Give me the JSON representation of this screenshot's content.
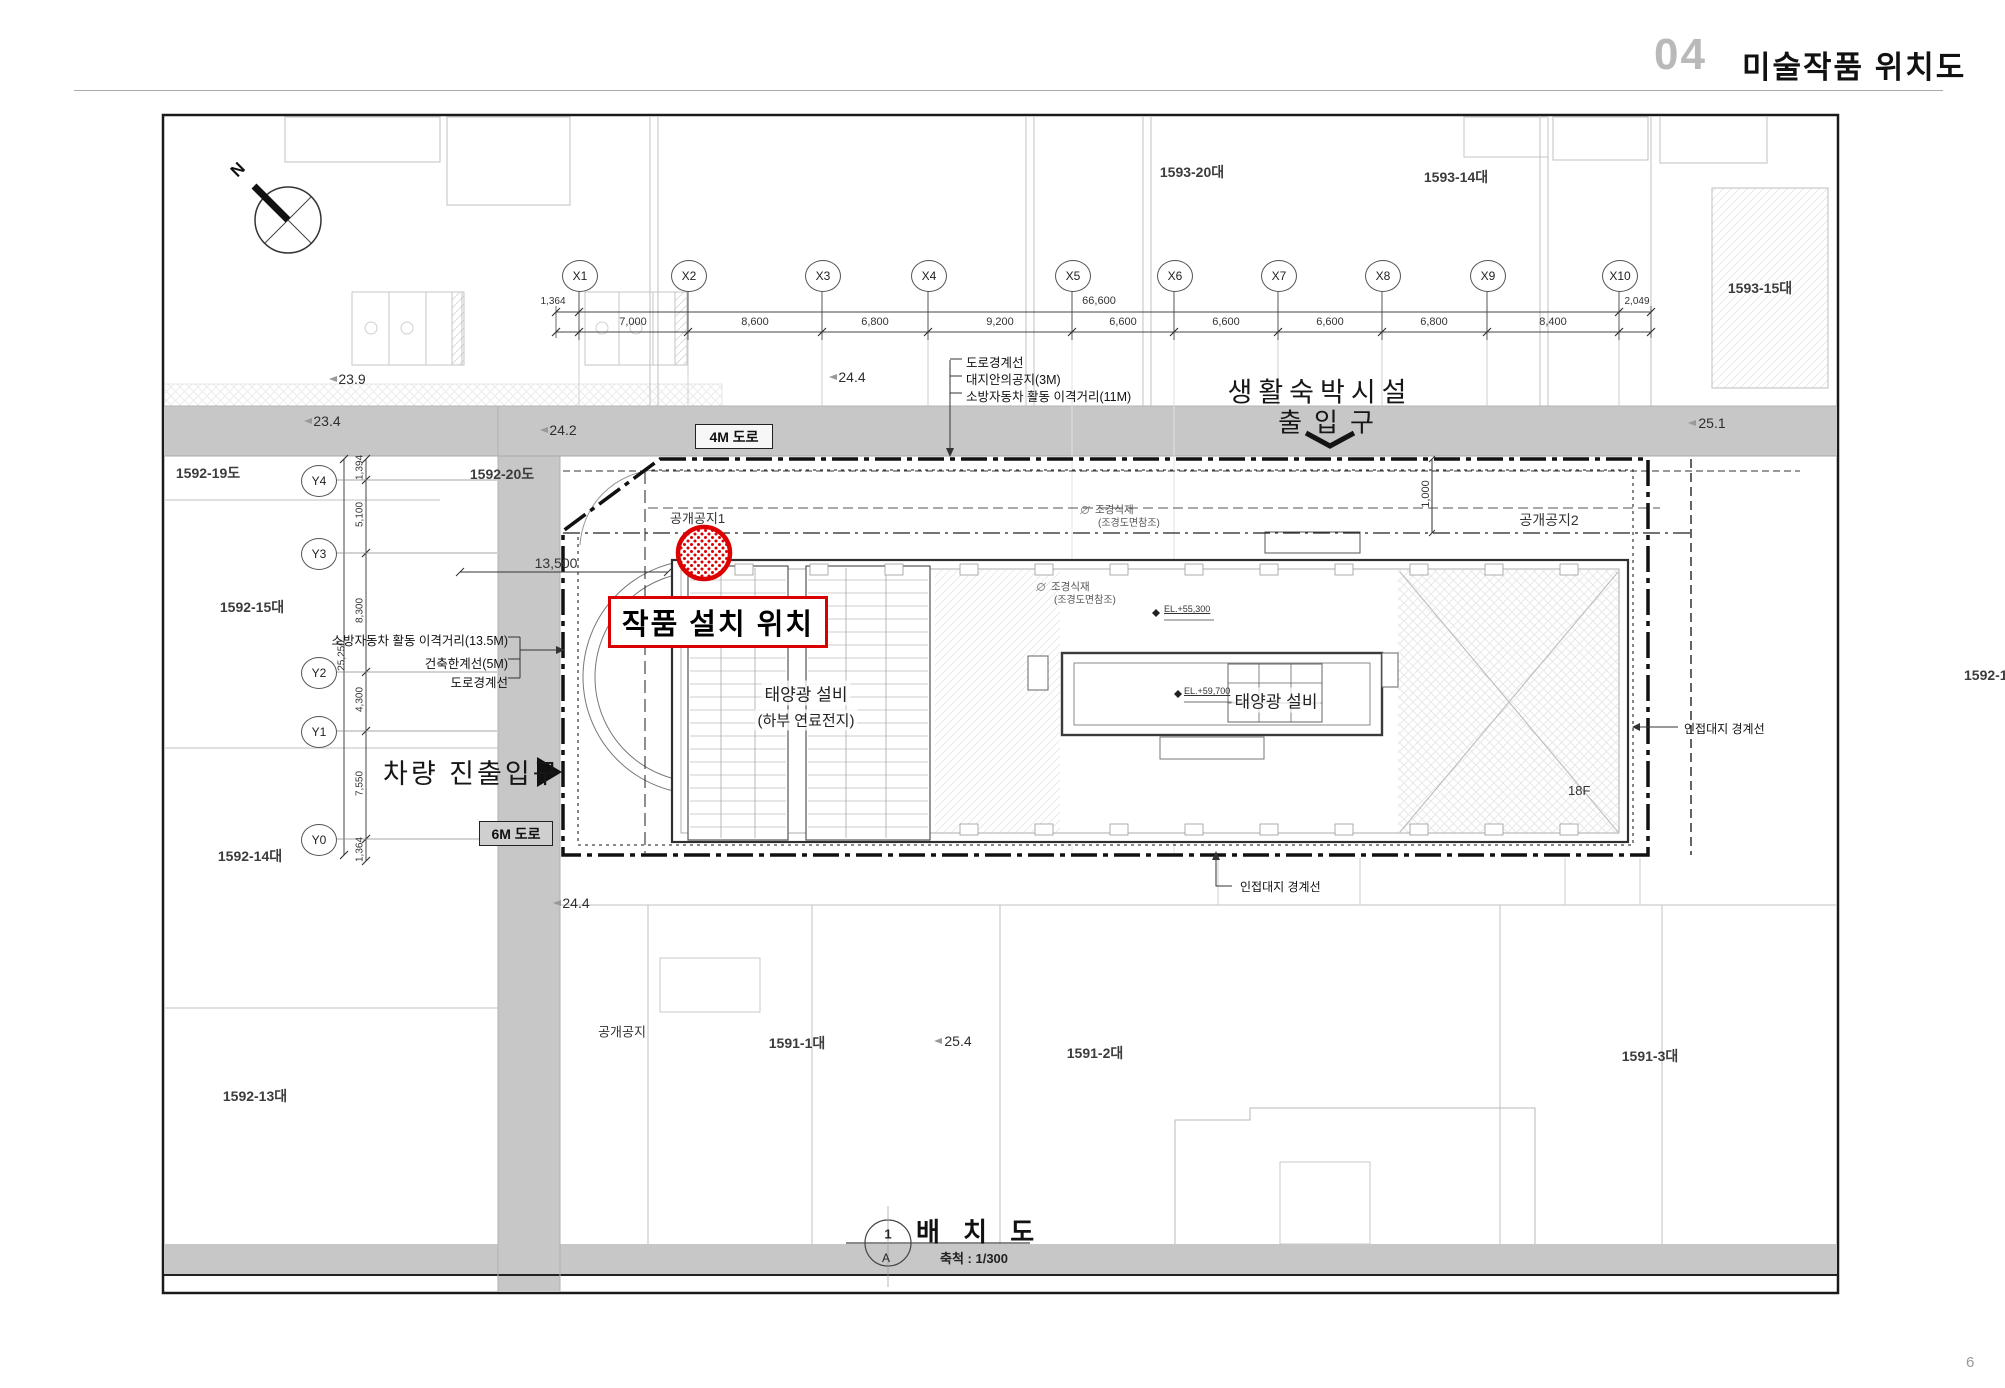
{
  "header": {
    "section_number": "04",
    "title": "미술작품 위치도",
    "page_number": "6"
  },
  "compass": {
    "label": "N"
  },
  "grid": {
    "x_labels": [
      "X1",
      "X2",
      "X3",
      "X4",
      "X5",
      "X6",
      "X7",
      "X8",
      "X9",
      "X10"
    ],
    "x_dims": [
      "7,000",
      "8,600",
      "6,800",
      "9,200",
      "6,600",
      "6,600",
      "6,600",
      "6,800",
      "8,400"
    ],
    "x_dim_left": "1,364",
    "x_dim_right": "2,049",
    "x_dim_total": "66,600",
    "y_labels": [
      "Y4",
      "Y3",
      "Y2",
      "Y1",
      "Y0"
    ],
    "y_dims": [
      "1,394",
      "5,100",
      "8,300",
      "4,300",
      "7,550",
      "1,364"
    ],
    "y_dim_total": "25,250"
  },
  "lots": {
    "l1593_20": "1593-20대",
    "l1593_14": "1593-14대",
    "l1593_15": "1593-15대",
    "l1592_19": "1592-19도",
    "l1592_20": "1592-20도",
    "l1592_15": "1592-15대",
    "l1592_14": "1592-14대",
    "l1592_13": "1592-13대",
    "l1591_1": "1591-1대",
    "l1591_2": "1591-2대",
    "l1591_3": "1591-3대",
    "l_clipped": "1592-1"
  },
  "elevations": {
    "e239": "23.9",
    "e234": "23.4",
    "e242": "24.2",
    "e244a": "24.4",
    "e251": "25.1",
    "e244b": "24.4",
    "e254": "25.4"
  },
  "roads": {
    "r4m": "4M 도로",
    "r6m": "6M 도로"
  },
  "annotations": {
    "road_boundary_top": "도로경계선",
    "site_open_3m": "대지안의공지(3M)",
    "fire_11m": "소방자동차 활동 이격거리(11M)",
    "facility_name": "생활숙박시설",
    "facility_entrance": "출입구",
    "open_space_1": "공개공지1",
    "open_space_2": "공개공지2",
    "open_space": "공개공지",
    "artwork_label": "작품 설치 위치",
    "fire_13_5m": "소방자동차 활동 이격거리(13.5M)",
    "building_limit_5m": "건축한계선(5M)",
    "road_boundary_left": "도로경계선",
    "vehicle_entrance": "차량 진출입구",
    "solar_label_1": "태양광 설비",
    "solar_label_1b": "(하부 연료전지)",
    "solar_label_2": "태양광 설비",
    "adjacent_boundary_right": "인접대지 경계선",
    "adjacent_boundary_bottom": "인접대지 경계선",
    "floor_18f": "18F",
    "landscape_1a": "조경식재",
    "landscape_1b": "(조경도면참조)",
    "landscape_2a": "조경식재",
    "landscape_2b": "(조경도면참조)",
    "el_55300": "EL.+55,300",
    "el_59700": "EL.+59,700",
    "dim_13500": "13,500",
    "dim_1000": "1,000"
  },
  "title_block": {
    "number": "1",
    "sheet": "A",
    "title": "배 치 도",
    "scale": "축척 : 1/300"
  },
  "colors": {
    "accent_red": "#dd0000",
    "road_gray": "#c7c7c7"
  }
}
